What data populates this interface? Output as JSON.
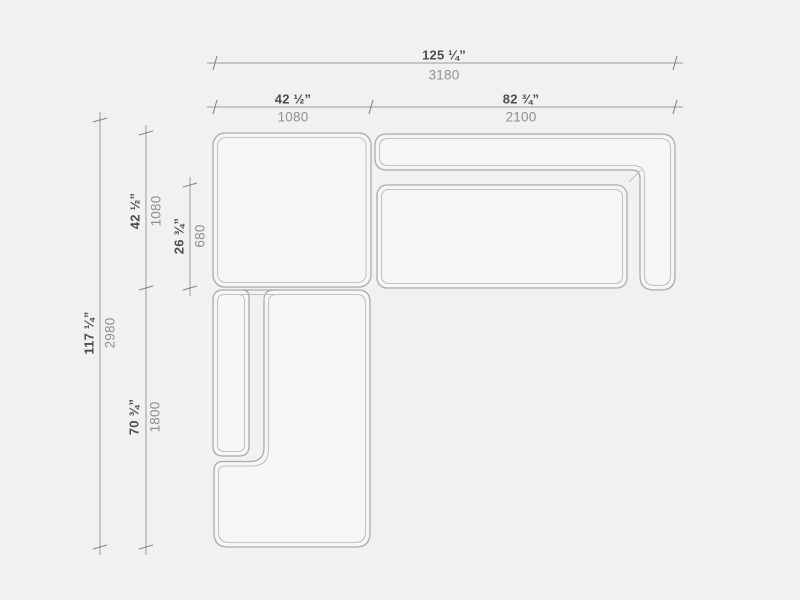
{
  "drawing": {
    "type": "sectional-sofa-top-view-technical-drawing",
    "units_shown": [
      "inches",
      "millimeters"
    ]
  },
  "colors": {
    "background": "#f1f1f1",
    "module_fill": "#f6f6f6",
    "outline": "#ababab",
    "inner_line": "#c2c2c2",
    "dim_line": "#9a9a9a",
    "dim_text_primary": "#4d4d4d",
    "dim_text_secondary": "#8f8f8f"
  },
  "dimensions": {
    "total_width": {
      "inches": "125 ¼”",
      "mm": "3180"
    },
    "corner_module_width": {
      "inches": "42 ½”",
      "mm": "1080"
    },
    "sofa_module_width": {
      "inches": "82 ¾”",
      "mm": "2100"
    },
    "total_depth": {
      "inches": "117 ¼”",
      "mm": "2980"
    },
    "corner_module_depth": {
      "inches": "42 ½”",
      "mm": "1080"
    },
    "seat_depth": {
      "inches": "26 ¾”",
      "mm": "680"
    },
    "chaise_length": {
      "inches": "70 ¾”",
      "mm": "1800"
    }
  }
}
